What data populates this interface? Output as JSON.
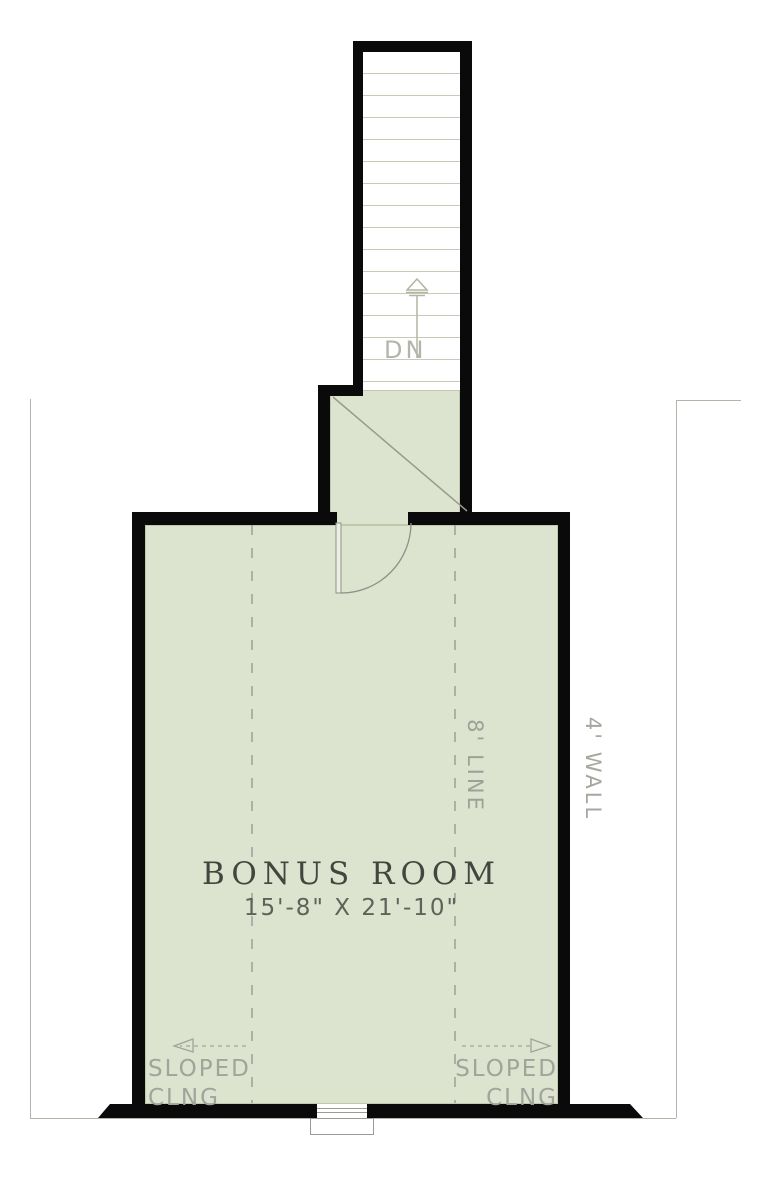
{
  "plan": {
    "stairs": {
      "down_label": "DN"
    },
    "room": {
      "name": "BONUS ROOM",
      "dimensions": "15'-8\" X 21'-10\""
    },
    "annotations": {
      "eight_ft_line": "8' LINE",
      "four_ft_wall": "4' WALL",
      "sloped_left": {
        "line1": "SLOPED",
        "line2": "CLNG"
      },
      "sloped_right": {
        "line1": "SLOPED",
        "line2": "CLNG"
      }
    },
    "colors": {
      "floor_fill": "#dce3ce",
      "wall": "#0a0a0a",
      "annotation_gray": "#a2a39b",
      "room_text": "#43463e"
    }
  }
}
